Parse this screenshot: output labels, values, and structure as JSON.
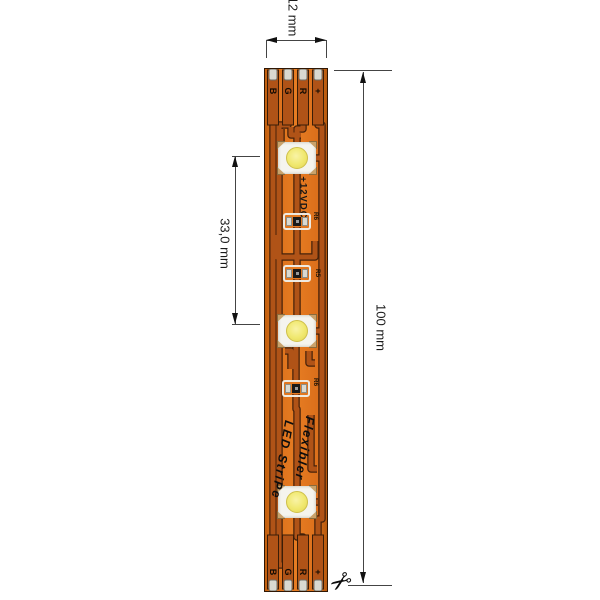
{
  "dimensions": {
    "width": {
      "value": "12 mm"
    },
    "length": {
      "value": "100 mm"
    },
    "spacing": {
      "value": "33,0 mm"
    }
  },
  "strip": {
    "voltage": "+12VDC",
    "brand_line1": "Flexibler",
    "brand_line2": "LED StriPe",
    "top_pads": [
      "B",
      "G",
      "R",
      "+"
    ],
    "bottom_pads": [
      "B",
      "G",
      "R",
      "+"
    ],
    "resistors": [
      {
        "label": "R6"
      },
      {
        "label": "R5"
      },
      {
        "label": "R6"
      }
    ],
    "led_count": "3"
  },
  "icons": {
    "scissors": "✂"
  },
  "colors": {
    "strip": "#DB6F1B",
    "trace": "#B05317",
    "trace_outline": "#47220A",
    "pad_silver": "#D9D9D1",
    "led_body": "#F5F4EE",
    "led_chip": "#F0E86E",
    "dim_line": "#444444",
    "text": "#1A1A1A"
  }
}
